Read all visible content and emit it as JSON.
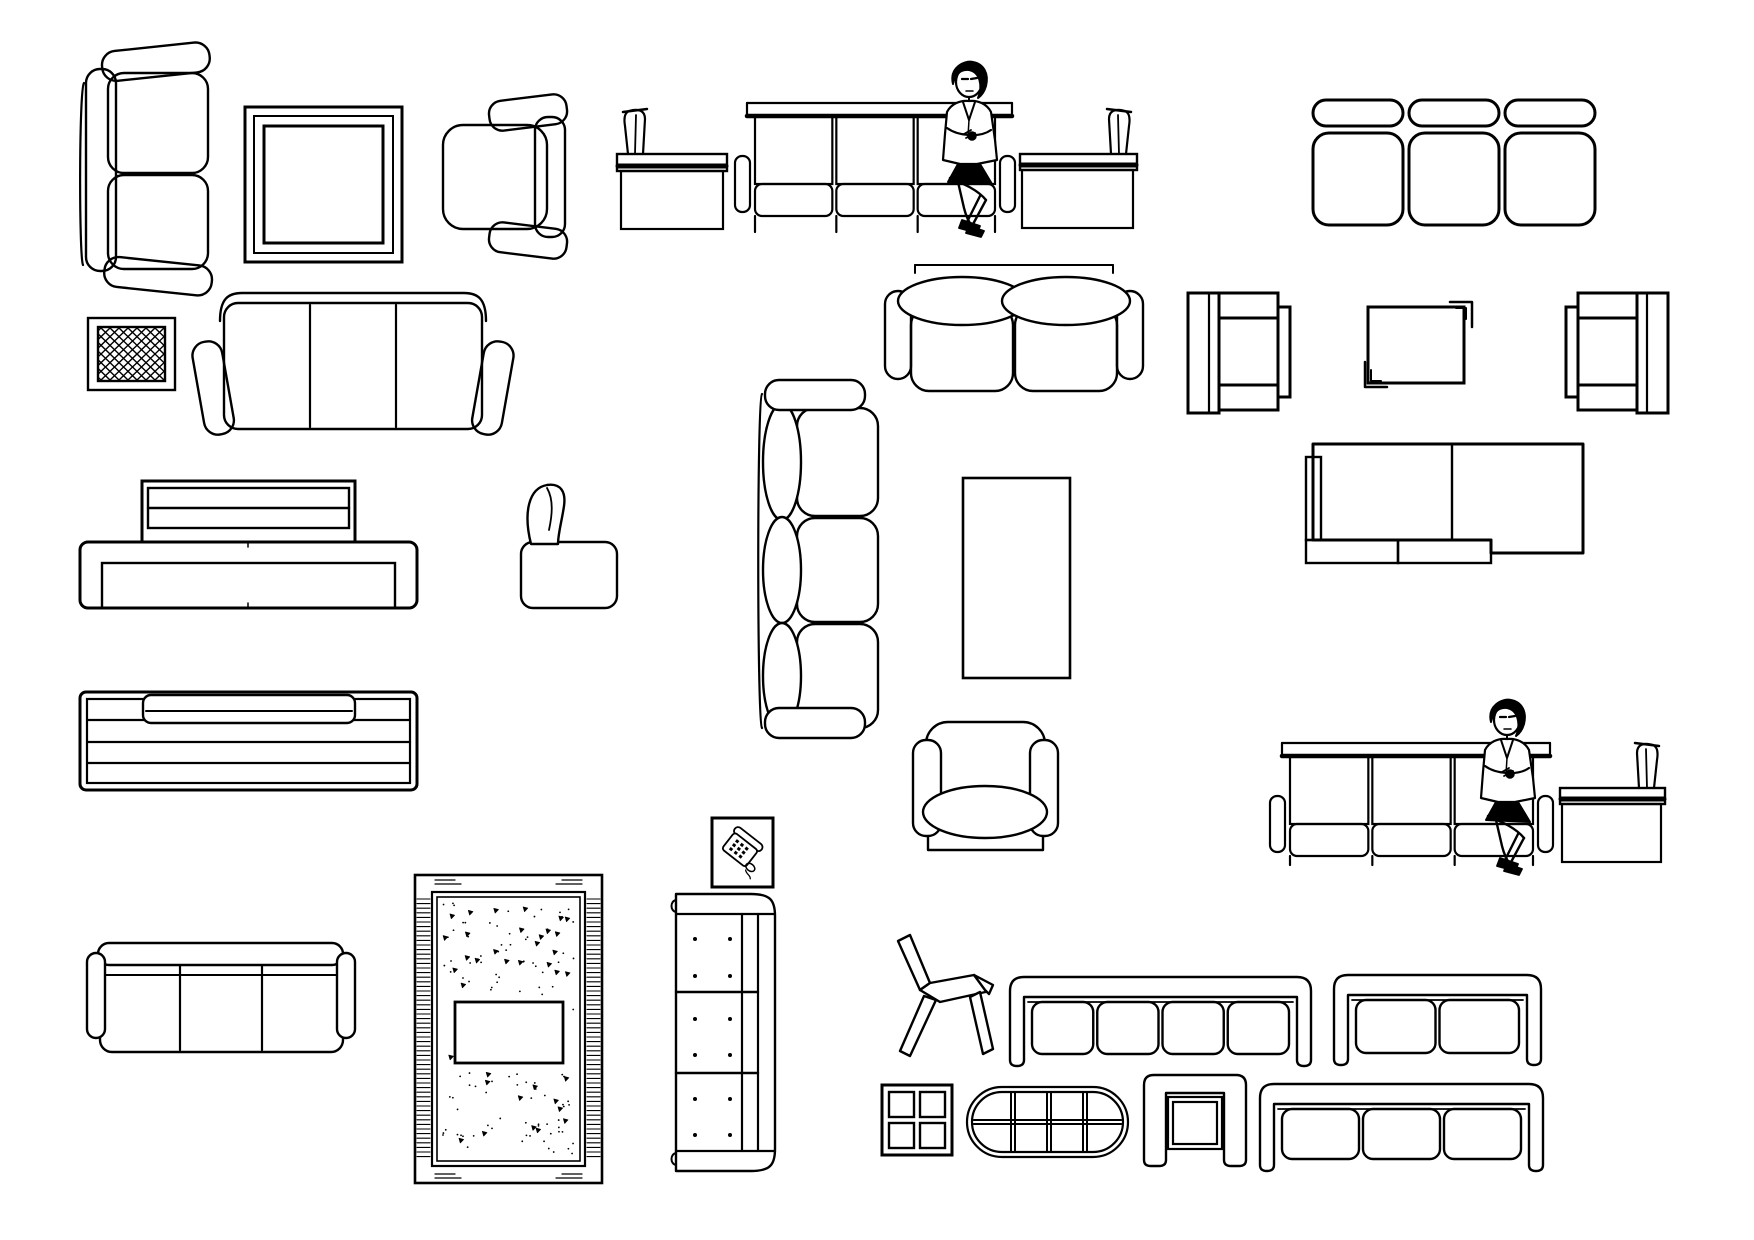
{
  "sheet": {
    "title": "Living room furniture CAD blocks sheet",
    "background": "#ffffff",
    "line_color": "#000000",
    "width": 1754,
    "height": 1240
  },
  "items": [
    {
      "id": "sofa-2seat-plan-vertical",
      "type": "vertSofa2",
      "label": "two-seat sofa plan view vertical",
      "x": 78,
      "y": 45,
      "w": 137,
      "h": 248
    },
    {
      "id": "square-side-table",
      "type": "squareTable",
      "label": "square table with nested frame",
      "x": 245,
      "y": 107,
      "w": 157,
      "h": 155
    },
    {
      "id": "armchair-plan-facing-left",
      "type": "armchairPlanL",
      "label": "armchair plan view facing left",
      "x": 437,
      "y": 95,
      "w": 130,
      "h": 163
    },
    {
      "id": "waiting-chair-elevation-left",
      "type": "chairElevL",
      "label": "waiting chair elevation back post left",
      "x": 617,
      "y": 108,
      "w": 110,
      "h": 124
    },
    {
      "id": "waiting-bench-3seat-elevation-top",
      "type": "benchElev",
      "label": "three-seat waiting bench elevation",
      "x": 735,
      "y": 100,
      "w": 280,
      "h": 132
    },
    {
      "id": "seated-woman-top",
      "type": "woman",
      "label": "seated woman figure",
      "x": 920,
      "y": 60,
      "w": 95,
      "h": 172
    },
    {
      "id": "waiting-chair-elevation-right-top",
      "type": "chairElevR",
      "label": "waiting chair elevation back post right",
      "x": 1020,
      "y": 108,
      "w": 117,
      "h": 124
    },
    {
      "id": "sofa-3seat-plan-no-arms",
      "type": "sofa3NoArms",
      "label": "three-seat sofa plan without arms",
      "x": 1313,
      "y": 100,
      "w": 282,
      "h": 128
    },
    {
      "id": "lattice-panel",
      "type": "latticeSquare",
      "label": "square panel with lattice hatch",
      "x": 88,
      "y": 318,
      "w": 87,
      "h": 72
    },
    {
      "id": "sofa-3seat-plan-arms",
      "type": "sofa3Arms",
      "label": "three-seat sofa plan with angled arms",
      "x": 196,
      "y": 291,
      "w": 314,
      "h": 146
    },
    {
      "id": "loveseat-plan-oval-backs",
      "type": "loveseat",
      "label": "loveseat plan with oval back cushions",
      "x": 885,
      "y": 263,
      "w": 258,
      "h": 130
    },
    {
      "id": "armchair-schematic-facing-right",
      "type": "armchairSchemR",
      "label": "armchair schematic plan facing right",
      "x": 1188,
      "y": 293,
      "w": 102,
      "h": 120
    },
    {
      "id": "corner-bracket-table",
      "type": "cornerTable",
      "label": "table with corner brackets",
      "x": 1365,
      "y": 302,
      "w": 107,
      "h": 85
    },
    {
      "id": "armchair-schematic-facing-left",
      "type": "armchairSchemL",
      "label": "armchair schematic plan facing left",
      "x": 1566,
      "y": 293,
      "w": 102,
      "h": 120
    },
    {
      "id": "sofa-back-elevation-headrest",
      "type": "sofaBackElev1",
      "label": "sofa rear elevation with headrest",
      "x": 80,
      "y": 481,
      "w": 337,
      "h": 127
    },
    {
      "id": "club-chair-plan-small",
      "type": "chairSmallPlan",
      "label": "small club chair plan",
      "x": 521,
      "y": 482,
      "w": 112,
      "h": 128
    },
    {
      "id": "sofa-3seat-plan-vertical",
      "type": "vertSofa3",
      "label": "three-seat sofa plan vertical facing right",
      "x": 757,
      "y": 380,
      "w": 121,
      "h": 358
    },
    {
      "id": "rectangular-coffee-table",
      "type": "rectTable",
      "label": "rectangular coffee table",
      "x": 963,
      "y": 478,
      "w": 107,
      "h": 200
    },
    {
      "id": "modular-sofa-schematic",
      "type": "sectional",
      "label": "modular sofa schematic plan",
      "x": 1306,
      "y": 444,
      "w": 277,
      "h": 119
    },
    {
      "id": "sofa-back-elevation-striped",
      "type": "sofaBackElev2",
      "label": "sofa rear elevation with rails",
      "x": 80,
      "y": 692,
      "w": 337,
      "h": 98
    },
    {
      "id": "armchair-plan-front",
      "type": "armchairFront",
      "label": "armchair plan with oval seat",
      "x": 913,
      "y": 722,
      "w": 145,
      "h": 130
    },
    {
      "id": "waiting-bench-3seat-elevation-bottom",
      "type": "benchElev",
      "label": "three-seat waiting bench elevation",
      "x": 1270,
      "y": 740,
      "w": 283,
      "h": 125
    },
    {
      "id": "seated-woman-bottom",
      "type": "woman",
      "label": "seated woman figure",
      "x": 1458,
      "y": 698,
      "w": 95,
      "h": 172
    },
    {
      "id": "waiting-chair-elevation-right-bottom",
      "type": "chairElevR",
      "label": "waiting chair elevation back post right",
      "x": 1560,
      "y": 742,
      "w": 105,
      "h": 123
    },
    {
      "id": "sofa-3seat-plan-small",
      "type": "sofa3Small",
      "label": "three-seat sofa plan compact",
      "x": 87,
      "y": 943,
      "w": 268,
      "h": 110
    },
    {
      "id": "area-rug",
      "type": "rug",
      "label": "area rug with fringe and speckle pattern",
      "x": 415,
      "y": 875,
      "w": 187,
      "h": 308
    },
    {
      "id": "telephone-symbol",
      "type": "phoneBox",
      "label": "telephone symbol block",
      "x": 712,
      "y": 818,
      "w": 61,
      "h": 69
    },
    {
      "id": "sofa-3seat-plan-tufted-vertical",
      "type": "vertSofaTufted",
      "label": "tufted three-seat sofa plan vertical",
      "x": 668,
      "y": 892,
      "w": 109,
      "h": 281
    },
    {
      "id": "lounge-chair-side-view",
      "type": "loungeSide",
      "label": "lounge chair side view sketch",
      "x": 890,
      "y": 935,
      "w": 105,
      "h": 128
    },
    {
      "id": "sofa-4seat-plan-frame",
      "type": "sofaU4",
      "label": "four-seat sofa plan U frame",
      "x": 1008,
      "y": 975,
      "w": 305,
      "h": 93
    },
    {
      "id": "sofa-2seat-plan-frame",
      "type": "sofaU2",
      "label": "two-seat sofa plan U frame",
      "x": 1332,
      "y": 973,
      "w": 211,
      "h": 94
    },
    {
      "id": "side-table-4pane",
      "type": "tableSquare4",
      "label": "square table four panes",
      "x": 882,
      "y": 1085,
      "w": 70,
      "h": 70
    },
    {
      "id": "oval-coffee-table",
      "type": "tableOval",
      "label": "oval coffee table with grid top",
      "x": 967,
      "y": 1087,
      "w": 161,
      "h": 70
    },
    {
      "id": "nesting-console-table",
      "type": "consoleU",
      "label": "nesting console table",
      "x": 1142,
      "y": 1073,
      "w": 106,
      "h": 95
    },
    {
      "id": "sofa-3seat-plan-frame",
      "type": "sofaU3",
      "label": "three-seat sofa plan U frame",
      "x": 1258,
      "y": 1082,
      "w": 287,
      "h": 91
    }
  ]
}
